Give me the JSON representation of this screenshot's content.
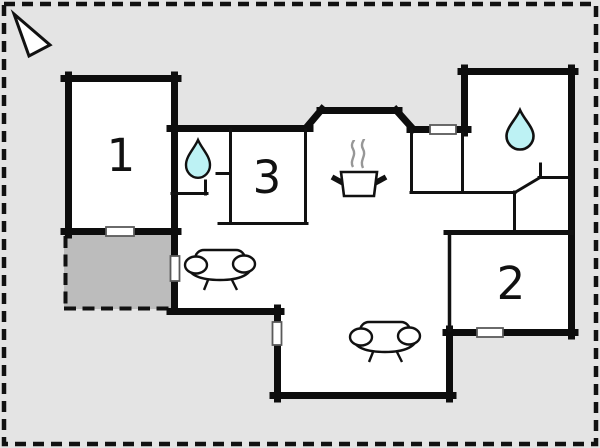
{
  "title": "Holiday home floor plan",
  "colors": {
    "background": "#e4e4e4",
    "wall": "#0d0d0d",
    "room_fill": "#ffffff",
    "terrace_fill": "#bcbcbc",
    "water_drop": "#bdf2f4",
    "steam": "#979797",
    "window_border": "#5a5a5a"
  },
  "rooms": [
    {
      "id": "room-1",
      "label": "1"
    },
    {
      "id": "room-2",
      "label": "2"
    },
    {
      "id": "room-3",
      "label": "3"
    }
  ],
  "features": {
    "north_arrow": "north-arrow-icon",
    "bathroom_markers": "water-drop-icon",
    "kitchen_marker": "cooking-pot-icon",
    "living_markers": "sofa-icon",
    "window_count": "5",
    "terrace": "dashed outline terrace"
  }
}
